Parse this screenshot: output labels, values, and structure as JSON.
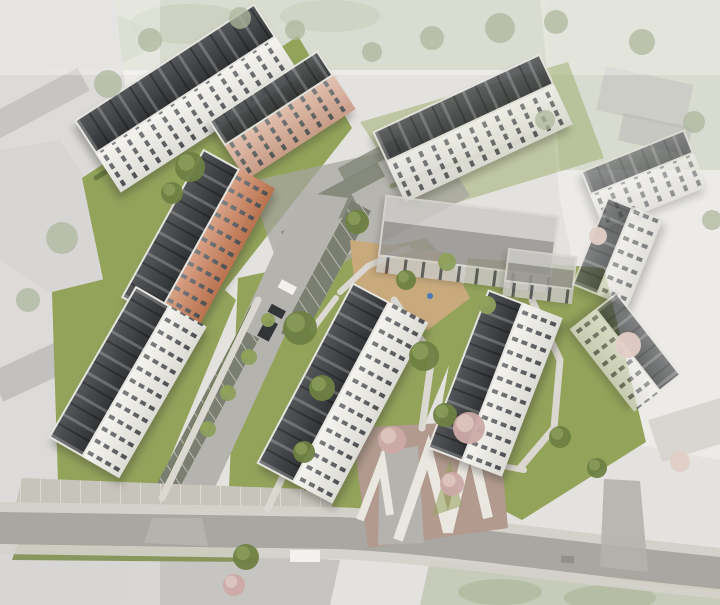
{
  "scene": {
    "kind": "aerial-architectural-rendering",
    "subject": "residential-estate-birdseye"
  },
  "colors": {
    "ground": "#e3e2de",
    "context_gray": "#c9c8c5",
    "context_roof": "#a5a4a1",
    "context_green": "#c2c8b4",
    "context_tree": "#aeb79c",
    "lawn": "#93a35a",
    "lawn_dark": "#7e9050",
    "hedge": "#5e7038",
    "tree": "#6e8142",
    "tree_light": "#8da05c",
    "blossom": "#ccaaa6",
    "blossom_light": "#e2cdc6",
    "road": "#a9a7a2",
    "road_light": "#b5b3ae",
    "sidewalk": "#d4d1cb",
    "paving": "#c7c4bb",
    "path": "#dbd8d1",
    "parking": "#7b7f71",
    "parking_light": "#a7a5a0",
    "playground": "#c9aa7d",
    "terrace_soil": "#b29a8e",
    "terrace_wall": "#e9e7e0",
    "roof_dark": "#3f4245",
    "roof_edge": "#e6e4df",
    "facade_white": "#f0eee8",
    "facade_orange": "#c97c55",
    "facade_salmon": "#dba994",
    "window": "#4e5154",
    "existing_roof": "#b4b2ad",
    "existing_wall": "#c9c7c2",
    "vehicle_dark": "#333639",
    "vehicle_white": "#f2f1ed",
    "wash": "rgba(255,255,255,0.32)"
  },
  "trees": [
    {
      "x": 190,
      "y": 167,
      "r": 15,
      "t": "green"
    },
    {
      "x": 172,
      "y": 193,
      "r": 11,
      "t": "green"
    },
    {
      "x": 357,
      "y": 222,
      "r": 12,
      "t": "green"
    },
    {
      "x": 300,
      "y": 328,
      "r": 17,
      "t": "green"
    },
    {
      "x": 322,
      "y": 388,
      "r": 13,
      "t": "green"
    },
    {
      "x": 304,
      "y": 452,
      "r": 11,
      "t": "green"
    },
    {
      "x": 424,
      "y": 356,
      "r": 15,
      "t": "green"
    },
    {
      "x": 445,
      "y": 415,
      "r": 12,
      "t": "green"
    },
    {
      "x": 487,
      "y": 305,
      "r": 9,
      "t": "light"
    },
    {
      "x": 560,
      "y": 437,
      "r": 11,
      "t": "green"
    },
    {
      "x": 597,
      "y": 468,
      "r": 10,
      "t": "green"
    },
    {
      "x": 246,
      "y": 557,
      "r": 13,
      "t": "green"
    },
    {
      "x": 208,
      "y": 429,
      "r": 8,
      "t": "light"
    },
    {
      "x": 228,
      "y": 393,
      "r": 8,
      "t": "light"
    },
    {
      "x": 249,
      "y": 357,
      "r": 8,
      "t": "light"
    },
    {
      "x": 268,
      "y": 320,
      "r": 7,
      "t": "light"
    },
    {
      "x": 406,
      "y": 280,
      "r": 10,
      "t": "green"
    },
    {
      "x": 447,
      "y": 262,
      "r": 9,
      "t": "light"
    },
    {
      "x": 392,
      "y": 440,
      "r": 14,
      "t": "blossom"
    },
    {
      "x": 469,
      "y": 428,
      "r": 16,
      "t": "blossom"
    },
    {
      "x": 452,
      "y": 484,
      "r": 12,
      "t": "blossom"
    },
    {
      "x": 234,
      "y": 585,
      "r": 11,
      "t": "blossom"
    },
    {
      "x": 628,
      "y": 345,
      "r": 13,
      "t": "blossom_muted"
    },
    {
      "x": 680,
      "y": 462,
      "r": 10,
      "t": "blossom_muted"
    },
    {
      "x": 598,
      "y": 236,
      "r": 9,
      "t": "blossom_muted"
    },
    {
      "x": 108,
      "y": 84,
      "r": 14,
      "t": "context"
    },
    {
      "x": 62,
      "y": 238,
      "r": 16,
      "t": "context"
    },
    {
      "x": 28,
      "y": 300,
      "r": 12,
      "t": "context"
    },
    {
      "x": 500,
      "y": 28,
      "r": 15,
      "t": "context"
    },
    {
      "x": 556,
      "y": 22,
      "r": 12,
      "t": "context"
    },
    {
      "x": 642,
      "y": 42,
      "r": 13,
      "t": "context"
    },
    {
      "x": 694,
      "y": 122,
      "r": 11,
      "t": "context"
    },
    {
      "x": 712,
      "y": 220,
      "r": 10,
      "t": "context"
    },
    {
      "x": 545,
      "y": 120,
      "r": 10,
      "t": "context"
    },
    {
      "x": 432,
      "y": 38,
      "r": 12,
      "t": "context"
    },
    {
      "x": 372,
      "y": 52,
      "r": 10,
      "t": "context"
    },
    {
      "x": 295,
      "y": 30,
      "r": 10,
      "t": "context"
    },
    {
      "x": 150,
      "y": 40,
      "r": 12,
      "t": "context"
    },
    {
      "x": 240,
      "y": 18,
      "r": 11,
      "t": "context"
    }
  ]
}
